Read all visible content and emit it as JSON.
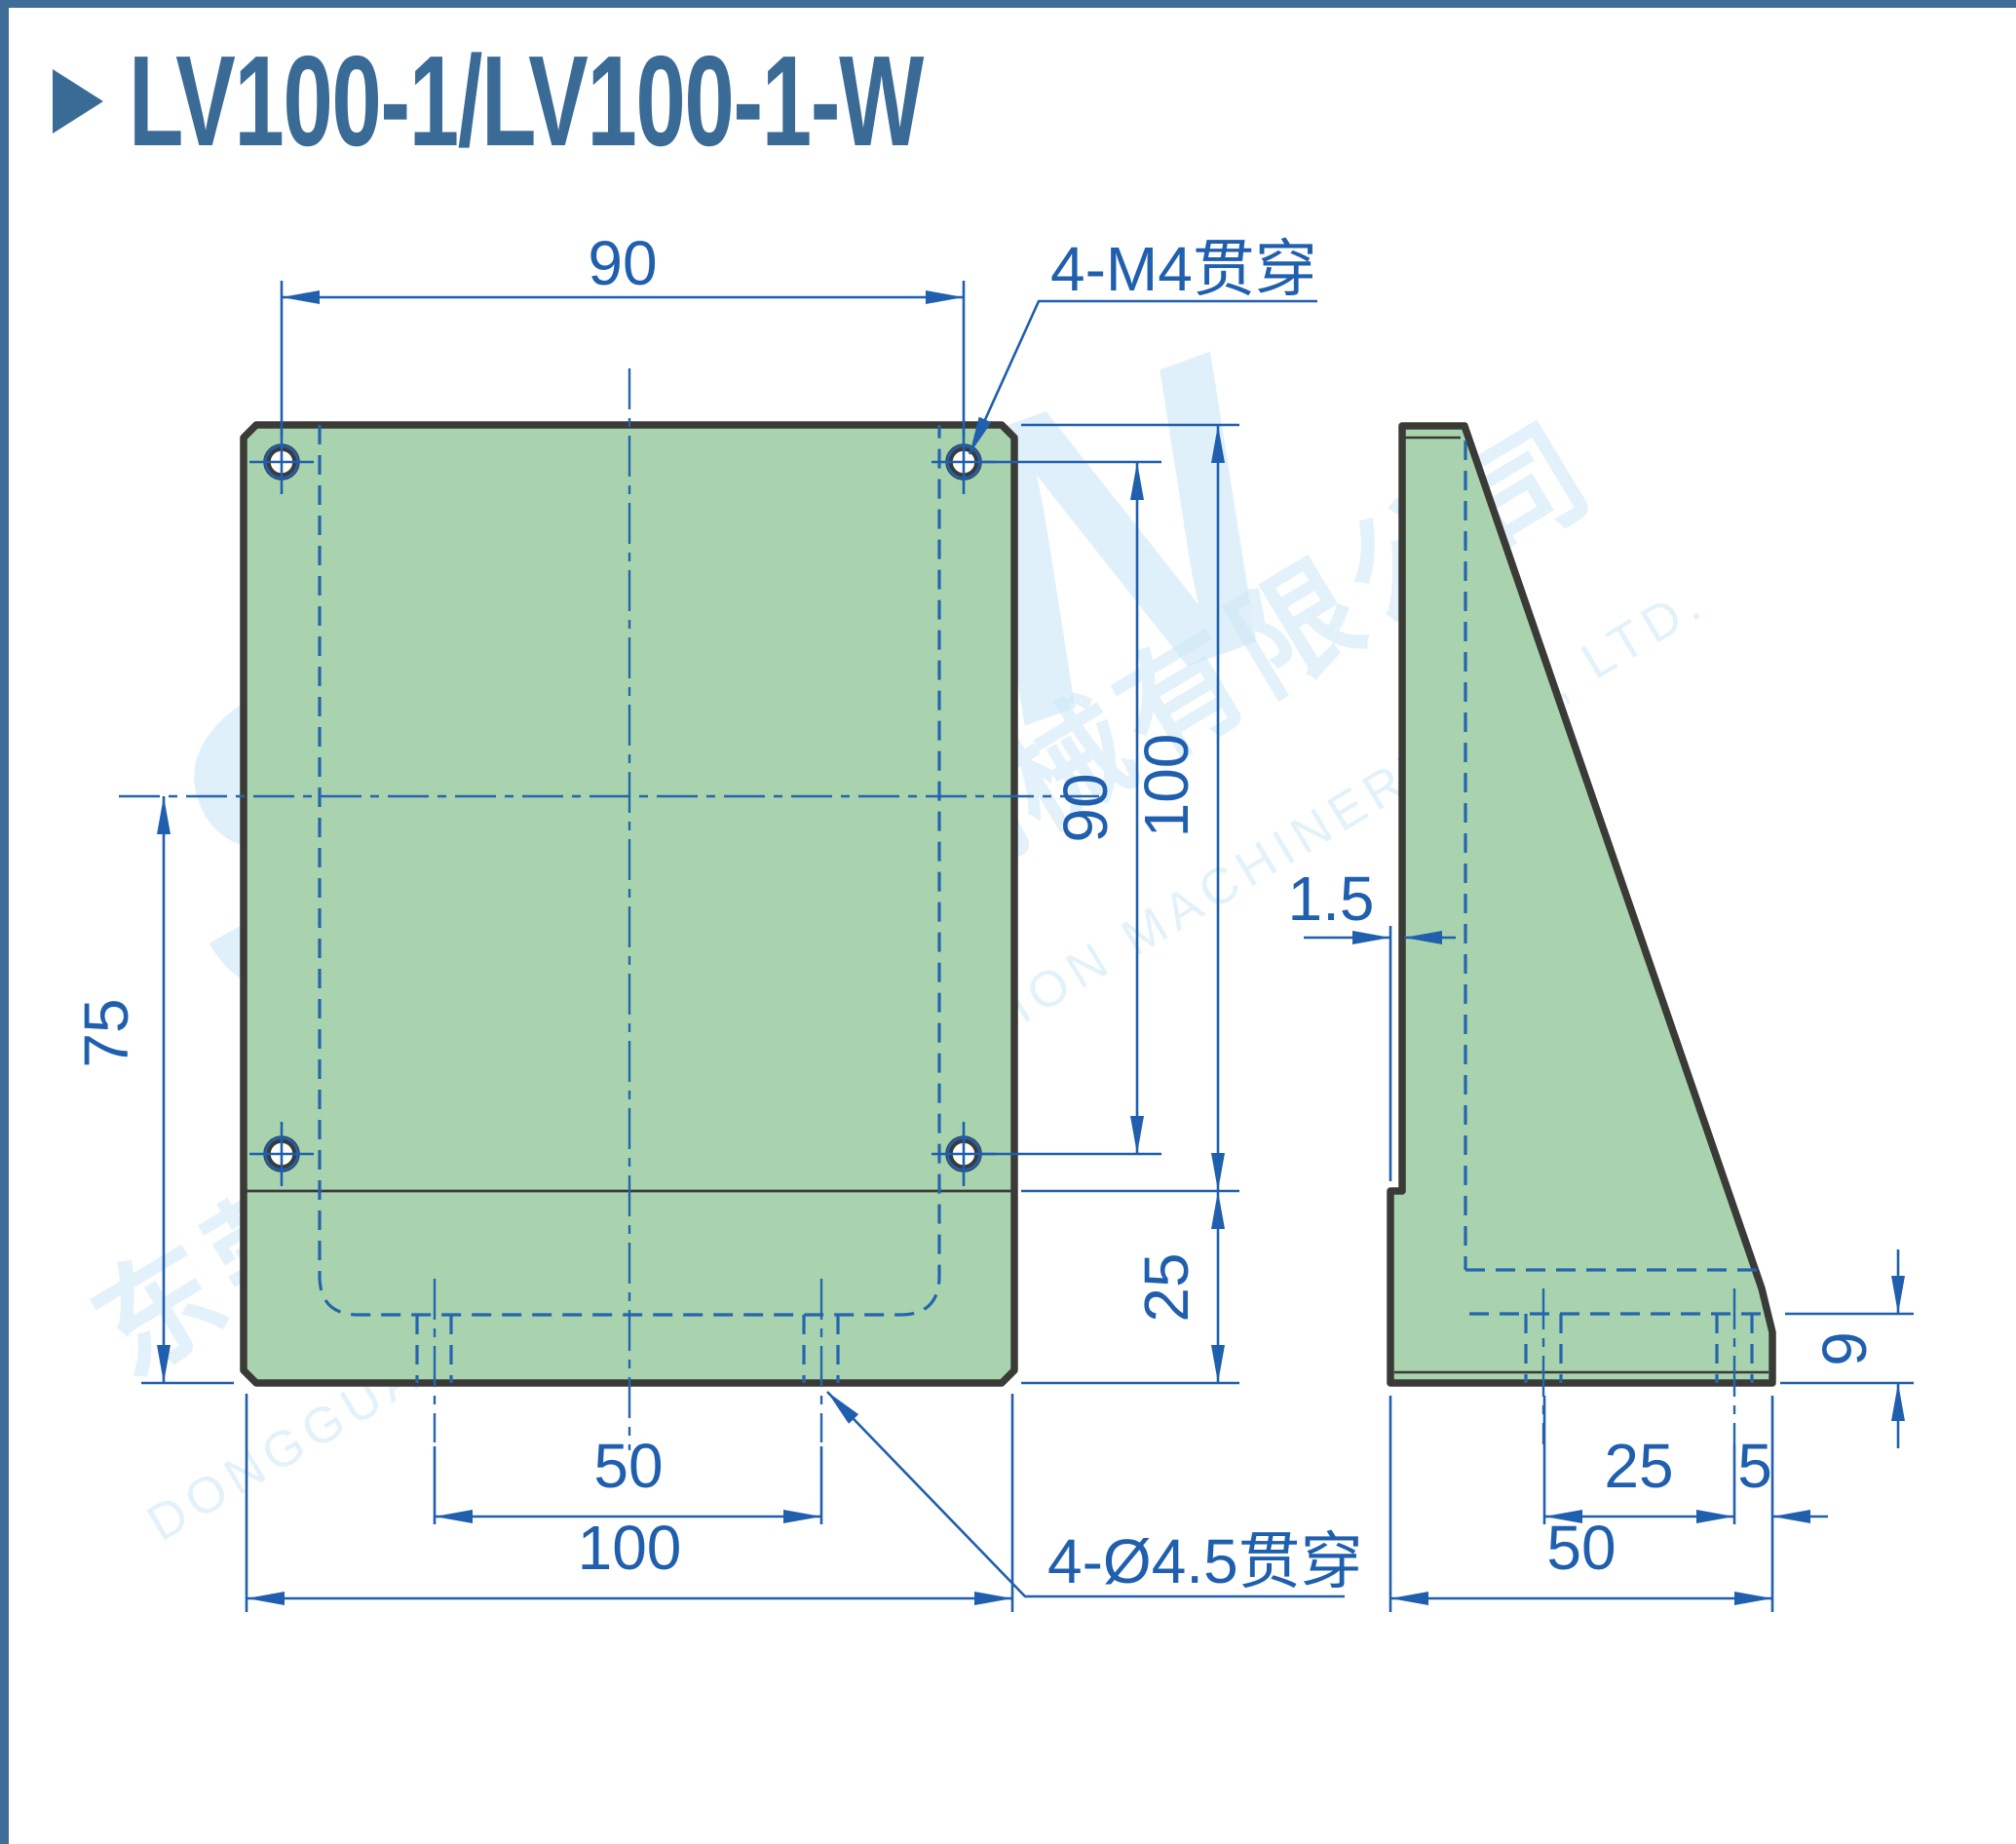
{
  "title": {
    "marker": "right-triangle",
    "text": "LV100-1/LV100-1-W"
  },
  "front_view": {
    "dims": {
      "hole_spacing_h": "90",
      "hole_spacing_v": "90",
      "plate_height": "100",
      "base_height": "25",
      "center_to_bottom": "75",
      "slot_spacing": "50",
      "width": "100"
    },
    "callouts": {
      "tapped_holes": "4-M4贯穿",
      "through_slots": "4-Ø4.5贯穿"
    }
  },
  "side_view": {
    "dims": {
      "face_offset": "1.5",
      "pocket_floor_height": "9",
      "slot_to_slot": "25",
      "slot_to_edge": "5",
      "depth": "50"
    }
  },
  "watermark": {
    "logo": "SELN",
    "company_cn": "东莞市盛菱精密机械有限公司",
    "company_en": "DONGGUAN SHENG LING PRECISION MACHINERY CO., LTD."
  },
  "colors": {
    "accent_blue": "#1f5fad",
    "title_blue": "#3a6b96",
    "frame_blue": "#3f6d98",
    "part_fill_green": "#a9d3ae",
    "part_outline": "#3a3a37",
    "watermark_blue": "#cfe8f7"
  }
}
